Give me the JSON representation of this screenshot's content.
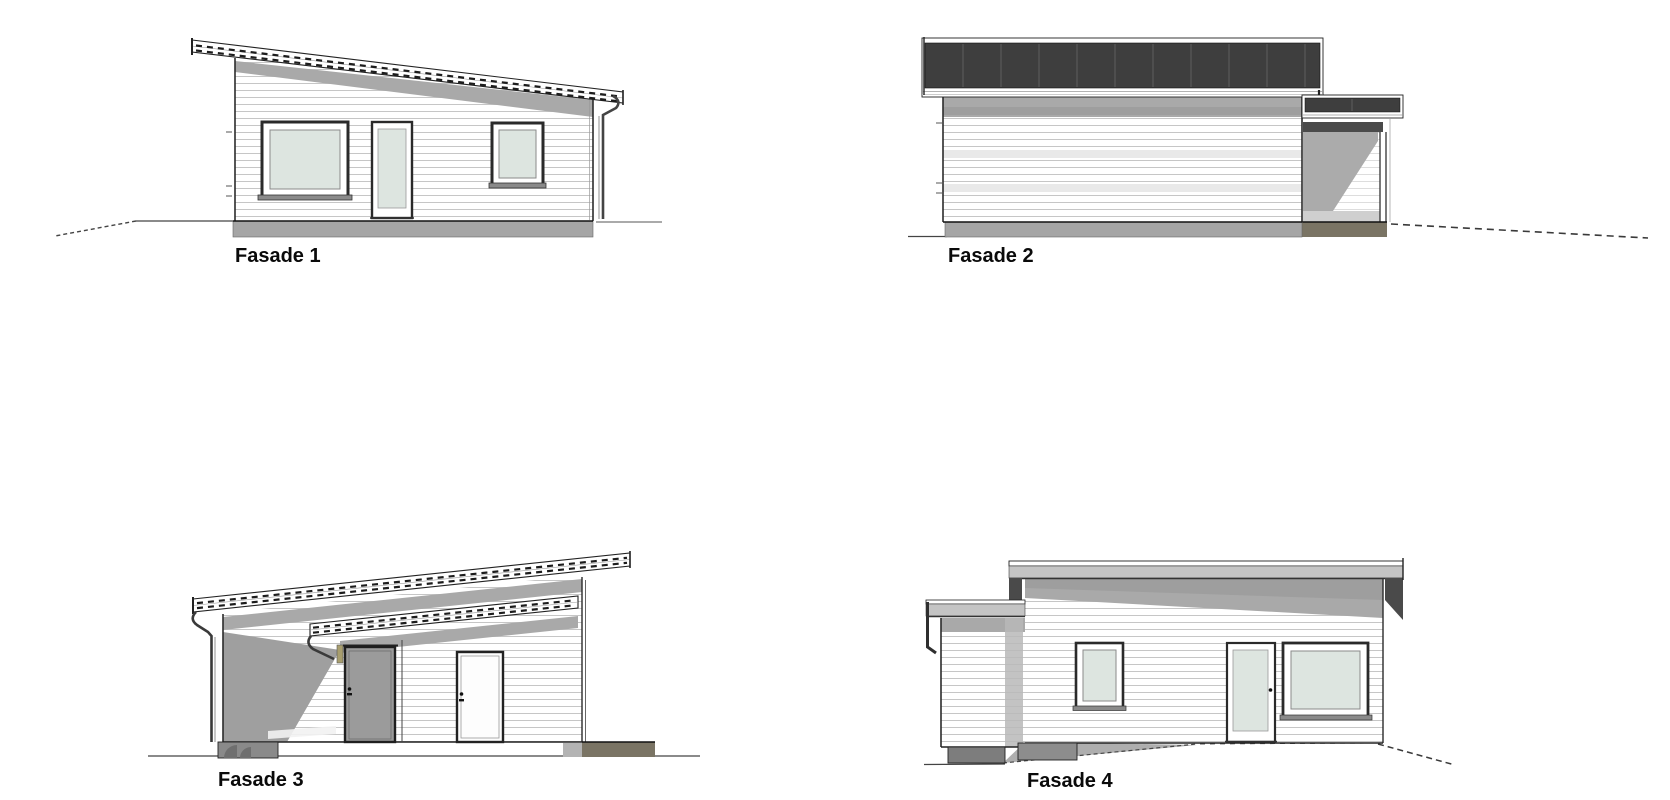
{
  "document": {
    "type": "architectural-facade-elevations",
    "background": "#ffffff"
  },
  "views": [
    {
      "id": "fasade-1",
      "label": "Fasade 1"
    },
    {
      "id": "fasade-2",
      "label": "Fasade 2"
    },
    {
      "id": "fasade-3",
      "label": "Fasade 3"
    },
    {
      "id": "fasade-4",
      "label": "Fasade 4"
    }
  ],
  "colors": {
    "roof_dark": "#3e3e3e",
    "roof_seam": "#5f5f5f",
    "fascia_gray": "#c4c4c4",
    "shadow_gray": "#a9a9a9",
    "shadow_dark": "#4a4a4a",
    "carport_shade": "#9f9f9f",
    "foundation_gray": "#a5a5a5",
    "footing_dark": "#8d8d8d",
    "footing_olive": "#7a7464",
    "glass_green": "#dde5e0",
    "door_gray": "#9b9b9b",
    "trim_tan": "#a89e6e",
    "line_dark": "#2b2b2b",
    "ground_line": "#444444",
    "siding_line": "#c6c6c6",
    "label_text": "#0a0a0a"
  }
}
